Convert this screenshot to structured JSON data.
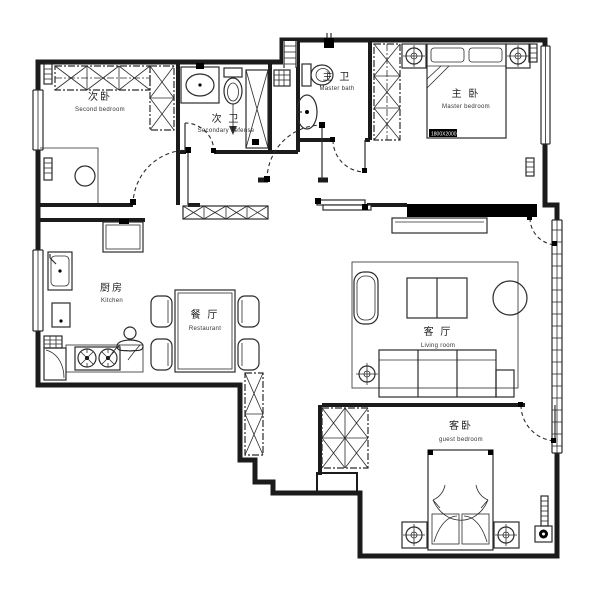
{
  "title": "Apartment floor plan",
  "rooms": {
    "second_bedroom": {
      "zh": "次卧",
      "en": "Second bedroom"
    },
    "secondary_bath": {
      "zh": "次 卫",
      "en": "Secondary defense"
    },
    "master_bath": {
      "zh": "主 卫",
      "en": "Master bath"
    },
    "master_bedroom": {
      "zh": "主 卧",
      "en": "Master bedroom"
    },
    "kitchen": {
      "zh": "厨房",
      "en": "Kitchen"
    },
    "dining": {
      "zh": "餐 厅",
      "en": "Restaurant"
    },
    "living": {
      "zh": "客 厅",
      "en": "Living room"
    },
    "guest_bedroom": {
      "zh": "客卧",
      "en": "guest bedroom"
    }
  },
  "annotations": {
    "master_bed_size": "1800X2000"
  },
  "fixtures": [
    "wardrobe",
    "shoe-cabinet",
    "tall-cabinet",
    "bed",
    "pillow",
    "nightstand",
    "ceiling-lamp",
    "sofa",
    "coffee-table",
    "round-chair",
    "lounge-chair",
    "rug",
    "tv-wall",
    "tv-cabinet",
    "dining-table",
    "chair",
    "fridge",
    "kitchen-sink",
    "stove",
    "washing-machine",
    "vent-grid",
    "bathroom-sink",
    "toilet",
    "bathtub",
    "shower",
    "shower-head",
    "floor-drain",
    "radiator",
    "window",
    "door-swing",
    "stool",
    "person"
  ],
  "colors": {
    "wall": "#1b1b1b",
    "line": "#2b2b2b",
    "accent_black": "#000000",
    "background": "#ffffff",
    "text": "#222222"
  }
}
